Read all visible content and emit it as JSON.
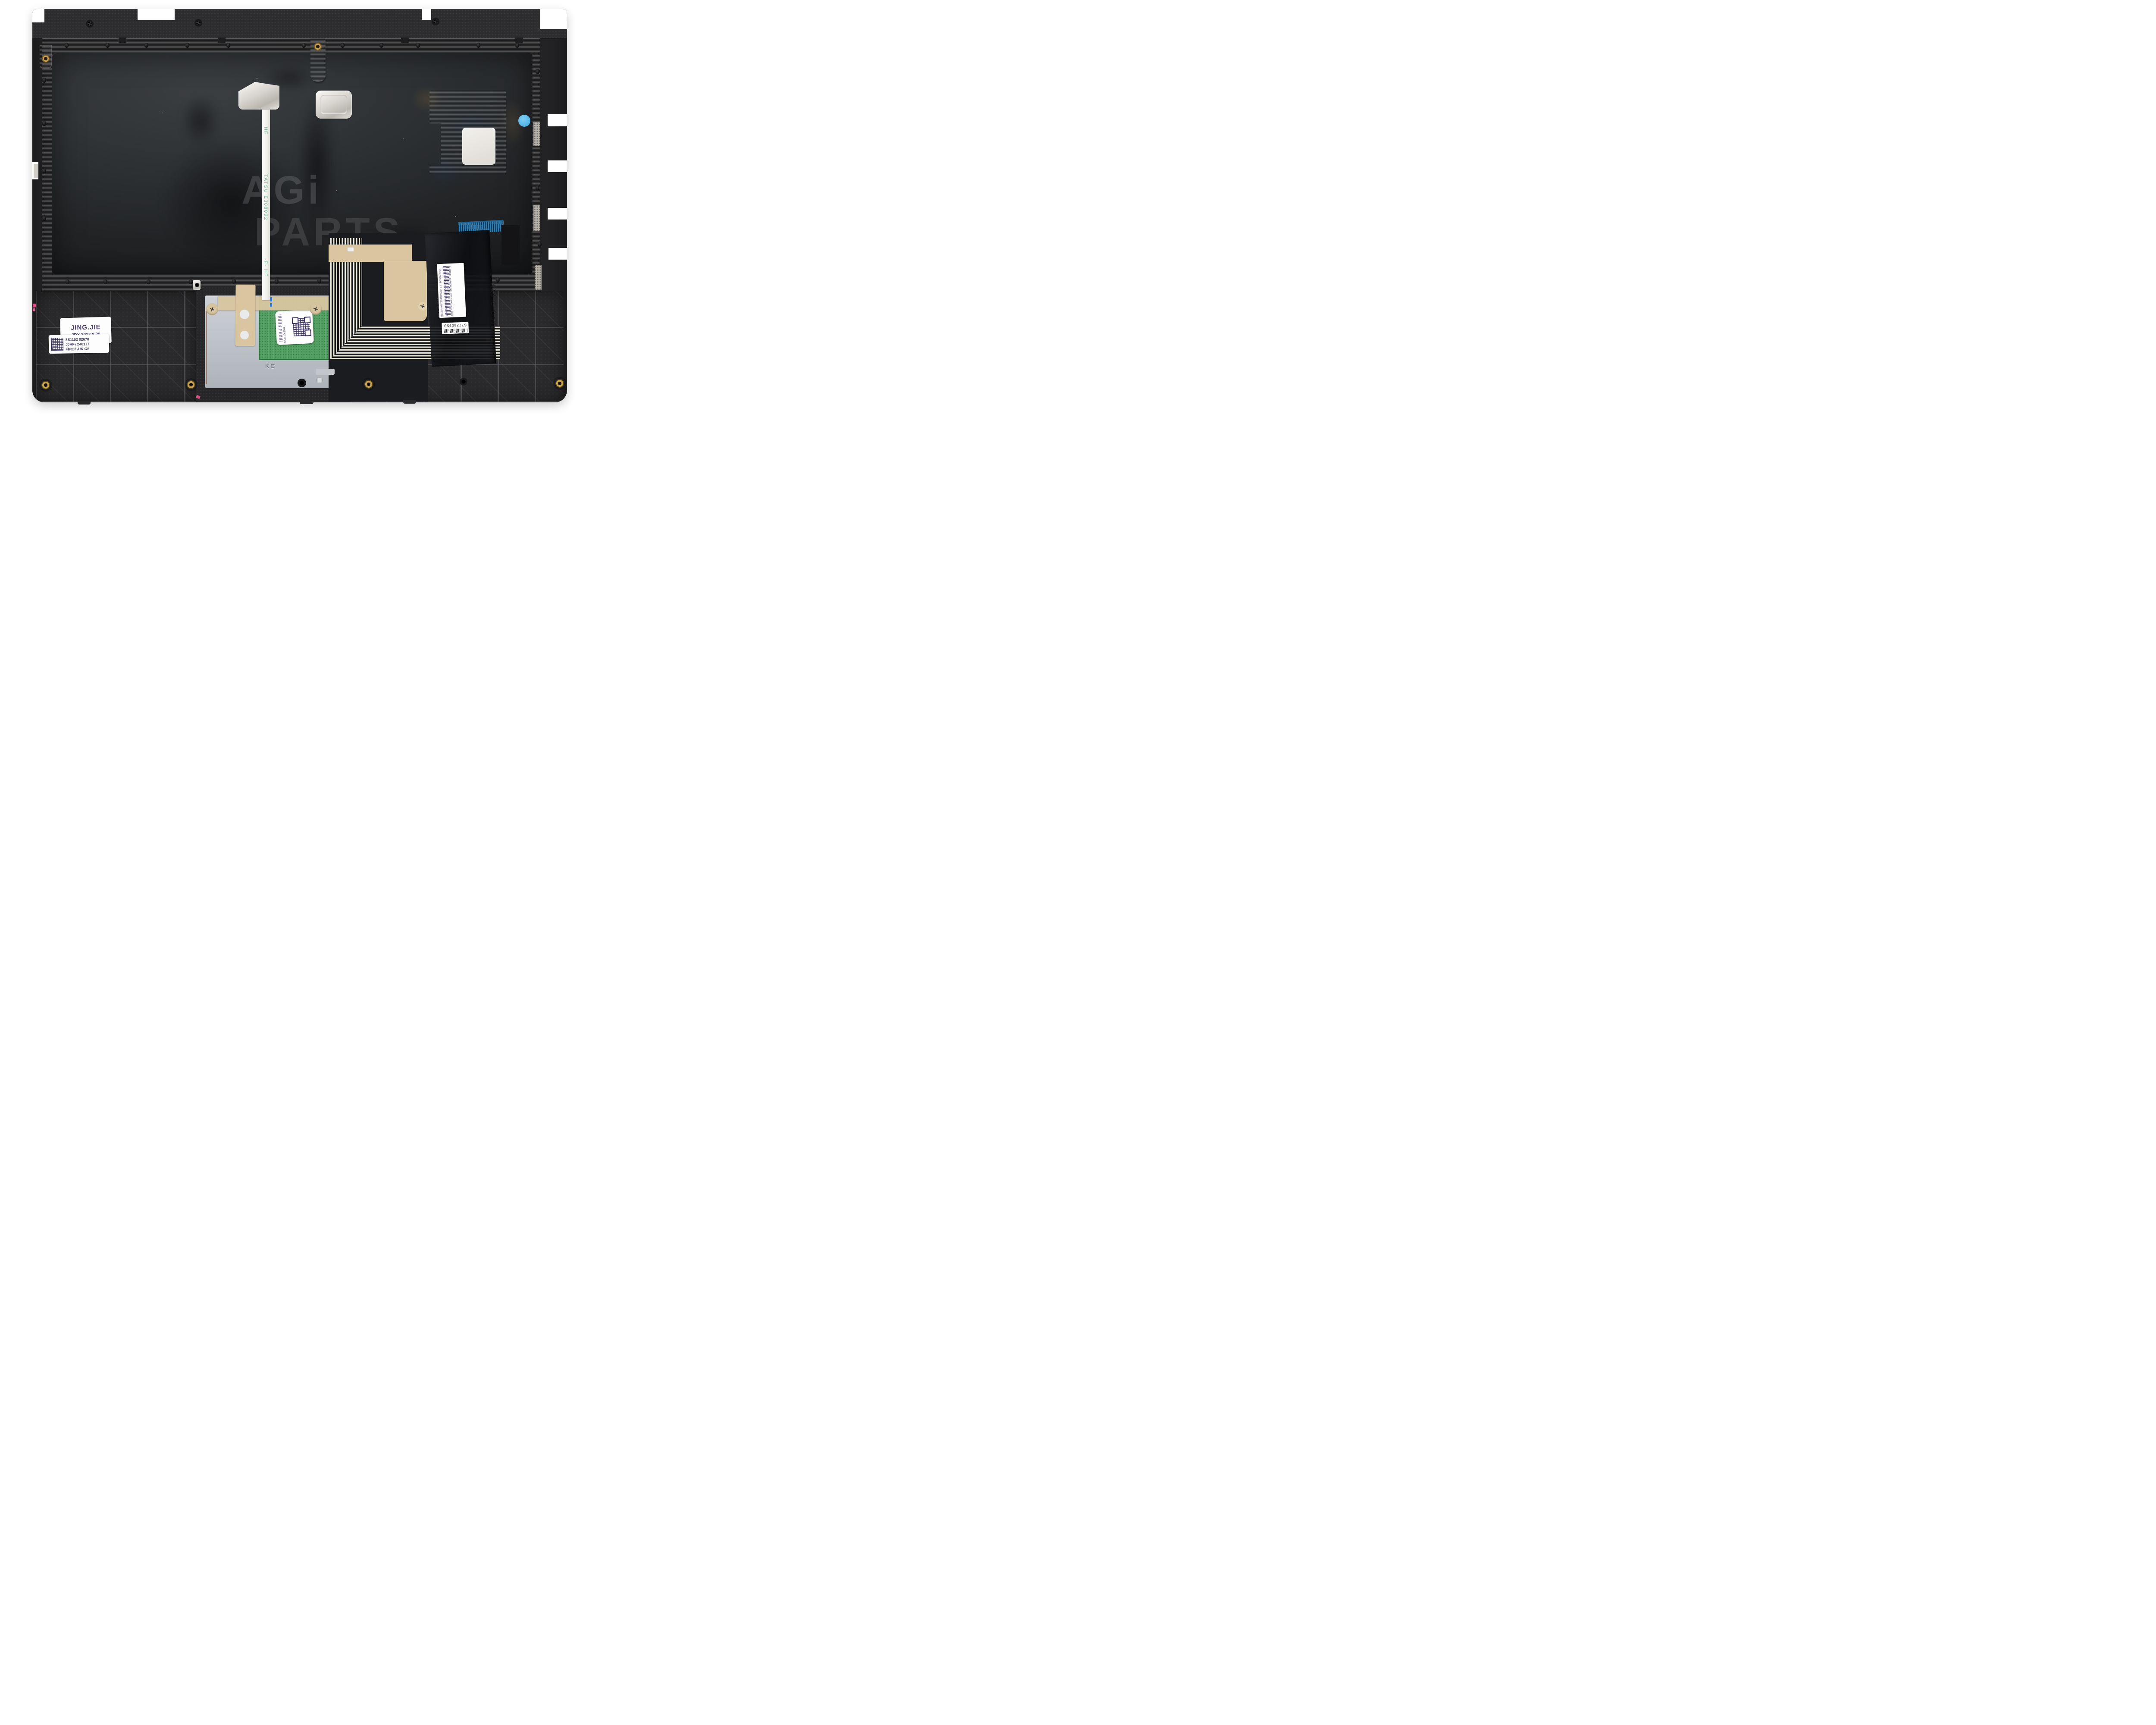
{
  "watermark": {
    "line1": "AGi",
    "line2": "PARTS"
  },
  "ribbon": {
    "mark_top": "HF",
    "mark_mid": "TATSU  E308092",
    "mark_low": "-F-  HF"
  },
  "labels": {
    "jing_stamp": {
      "line1": "JING.JIE",
      "line2": "JDX.2017.8.20"
    },
    "palmrest_sn": {
      "line1": "8S1102 02670",
      "line2": "JJHF7C40177",
      "line3": "Flex11-UK C#"
    },
    "touchpad_label": {
      "serial": "SA461D-2002"
    },
    "keyboard_label": {
      "line1": "BLT P/N:1204-02073   REV.:MP-0A",
      "line2": "CNY P/N:LCM16K66CU-6861   REV.:0A",
      "line3": "Lenovo P/N:      Model No:LCM16K6",
      "barcode_text": "8S1204-02073C1007AB0FEJ",
      "made_in": "Made in China",
      "ul_mark": "c UL us ®"
    },
    "keyboard_serial": "S7726095B"
  },
  "embossing": {
    "bracket_stamp": "KC",
    "chassis_mold": "N23 C Cover UK"
  },
  "colors": {
    "sticker_blue": "#58b7e8",
    "pcb_green": "#4f9a5e",
    "tape_tan": "#d9c6a1",
    "connector_blue": "#2e7fb5",
    "conductor_cream": "#eae6d9",
    "label_ink": "#4b3f66",
    "aluminum": "#d8d4cf",
    "plastic_black": "#2a2a2c"
  }
}
